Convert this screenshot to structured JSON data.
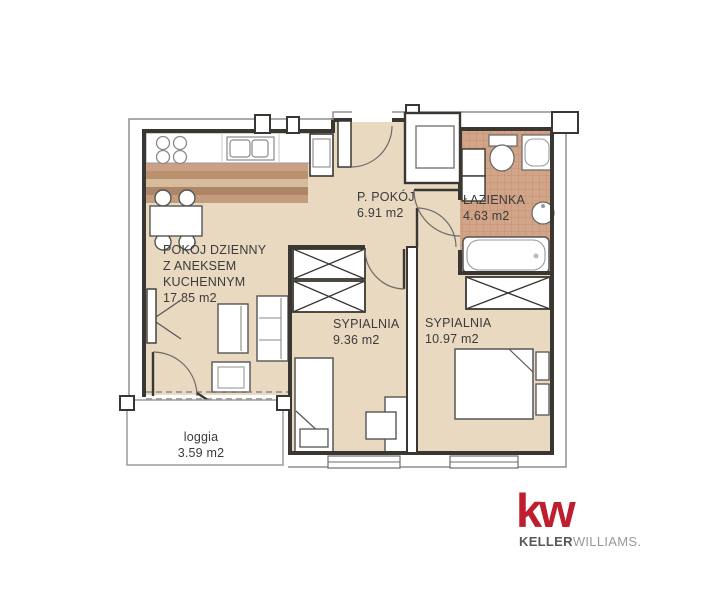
{
  "title": "apartment-floor-plan",
  "rooms": [
    {
      "name": "POKÓJ DZIENNY Z ANEKSEM KUCHENNYM",
      "area": "17.85 m2",
      "label": "POKÓJ DZIENNY\nZ ANEKSEM\nKUCHENNYM\n17.85 m2"
    },
    {
      "name": "P. POKÓJ",
      "area": "6.91 m2",
      "label": "P. POKÓJ\n6.91 m2"
    },
    {
      "name": "ŁAZIENKA",
      "area": "4.63 m2",
      "label": "ŁAZIENKA\n4.63 m2"
    },
    {
      "name": "SYPIALNIA",
      "area": "9.36 m2",
      "label": "SYPIALNIA\n9.36 m2"
    },
    {
      "name": "SYPIALNIA",
      "area": "10.97 m2",
      "label": "SYPIALNIA\n10.97 m2"
    },
    {
      "name": "loggia",
      "area": "3.59 m2",
      "label": "loggia\n3.59 m2"
    }
  ],
  "logo": {
    "mark": "kw",
    "brand_bold": "KELLER",
    "brand_light": "WILLIAMS."
  },
  "colors": {
    "floor": "#e8d9c0",
    "tile": "#d2a589",
    "wall": "#3a3733",
    "logo_red": "#be1e2d",
    "logo_gray": "#97999b"
  }
}
